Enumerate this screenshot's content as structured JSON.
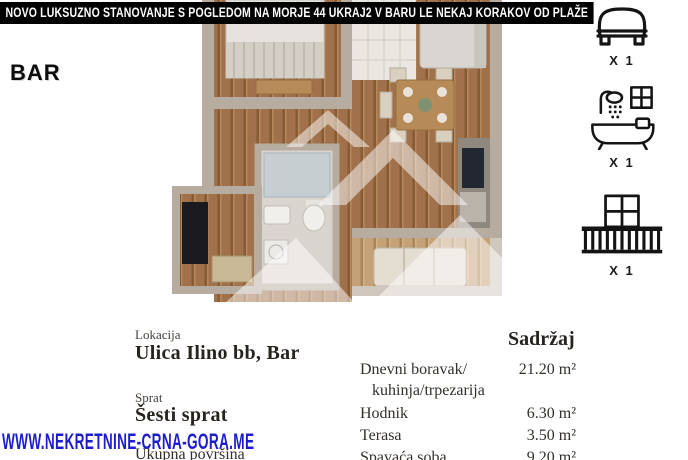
{
  "header": {
    "title": "NOVO LUKSUZNO STANOVANJE S POGLEDOM NA MORJE 44 UKRAJ2 V BARU LE NEKAJ KORAKOV OD PLAŽE",
    "region_label": "BAR"
  },
  "features": [
    {
      "icon": "bed-icon",
      "count": "X 1"
    },
    {
      "icon": "bathtub-icon",
      "count": "X 1"
    },
    {
      "icon": "balcony-icon",
      "count": "X 1"
    }
  ],
  "details": {
    "location_label": "Lokacija",
    "location_value": "Ulica Ilino bb, Bar",
    "floor_label": "Sprat",
    "floor_value": "Šesti sprat",
    "total_area_label": "Ukupna površina",
    "contents_header": "Sadržaj",
    "rooms": [
      {
        "name": "Dnevni boravak/",
        "name2": "kuhinja/trpezarija",
        "area": "21.20 m²"
      },
      {
        "name": "Hodnik",
        "area": "6.30 m²"
      },
      {
        "name": "Terasa",
        "area": "3.50 m²"
      },
      {
        "name": "Spavaća soba",
        "area": "9.20 m²"
      }
    ]
  },
  "watermark": {
    "text": "WWW.NEKRETNINE-CRNA-GORA.ME",
    "color": "#1d1dce"
  },
  "colors": {
    "title_bg": "#000000",
    "title_text": "#ffffff",
    "body_text": "#33302b",
    "wood_floor": "#a0714a",
    "walls": "#b7aca0"
  }
}
